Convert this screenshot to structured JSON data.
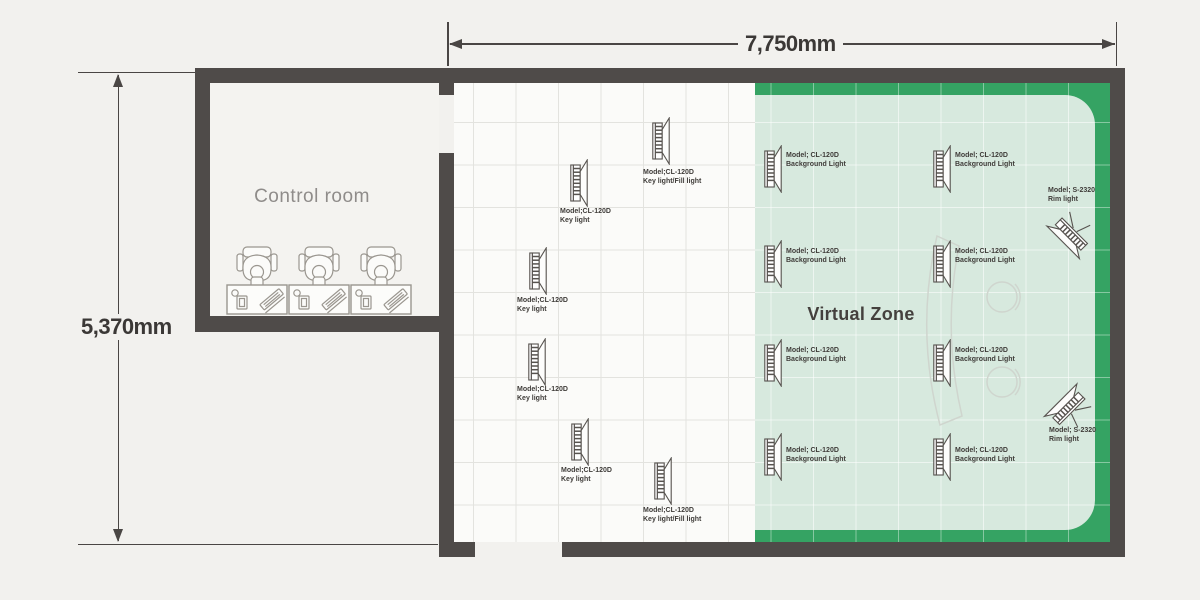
{
  "plan_title": "Studio lighting floor plan",
  "dimensions": {
    "width_label": "7,750mm",
    "height_label": "5,370mm"
  },
  "rooms": {
    "control_room_label": "Control room",
    "virtual_zone_label": "Virtual Zone",
    "workstation_count": 3
  },
  "colors": {
    "background": "#f2f1ee",
    "wall": "#4f4b49",
    "studio_floor": "#fbfbf9",
    "virtual_zone_accent": "#35a363",
    "virtual_zone_fill": "#d7e9de",
    "text_dark": "#3b3836",
    "text_gray": "#8f8c8a",
    "furniture_faint": "#cfd5ce"
  },
  "lights": [
    {
      "kind": "key",
      "model": "Model;CL-120D",
      "role": "Key light/Fill light",
      "x": 652,
      "y": 117,
      "label": {
        "x": 643,
        "y": 168
      }
    },
    {
      "kind": "key",
      "model": "Model;CL-120D",
      "role": "Key light",
      "x": 570,
      "y": 159,
      "label": {
        "x": 560,
        "y": 207
      }
    },
    {
      "kind": "key",
      "model": "Model;CL-120D",
      "role": "Key light",
      "x": 529,
      "y": 247,
      "label": {
        "x": 517,
        "y": 296
      }
    },
    {
      "kind": "key",
      "model": "Model;CL-120D",
      "role": "Key light",
      "x": 528,
      "y": 338,
      "label": {
        "x": 517,
        "y": 385
      }
    },
    {
      "kind": "key",
      "model": "Model;CL-120D",
      "role": "Key light",
      "x": 571,
      "y": 418,
      "label": {
        "x": 561,
        "y": 466
      }
    },
    {
      "kind": "key",
      "model": "Model;CL-120D",
      "role": "Key light/Fill light",
      "x": 654,
      "y": 457,
      "label": {
        "x": 643,
        "y": 506
      }
    },
    {
      "kind": "background",
      "model": "Model; CL-120D",
      "role": "Background Light",
      "x": 764,
      "y": 145,
      "label": {
        "x": 786,
        "y": 151
      }
    },
    {
      "kind": "background",
      "model": "Model; CL-120D",
      "role": "Background Light",
      "x": 764,
      "y": 240,
      "label": {
        "x": 786,
        "y": 247
      }
    },
    {
      "kind": "background",
      "model": "Model; CL-120D",
      "role": "Background Light",
      "x": 764,
      "y": 339,
      "label": {
        "x": 786,
        "y": 346
      }
    },
    {
      "kind": "background",
      "model": "Model; CL-120D",
      "role": "Background Light",
      "x": 764,
      "y": 433,
      "label": {
        "x": 786,
        "y": 446
      }
    },
    {
      "kind": "background",
      "model": "Model; CL-120D",
      "role": "Background Light",
      "x": 933,
      "y": 145,
      "label": {
        "x": 955,
        "y": 151
      }
    },
    {
      "kind": "background",
      "model": "Model; CL-120D",
      "role": "Background Light",
      "x": 933,
      "y": 240,
      "label": {
        "x": 955,
        "y": 247
      }
    },
    {
      "kind": "background",
      "model": "Model; CL-120D",
      "role": "Background Light",
      "x": 933,
      "y": 339,
      "label": {
        "x": 955,
        "y": 346
      }
    },
    {
      "kind": "background",
      "model": "Model; CL-120D",
      "role": "Background Light",
      "x": 933,
      "y": 433,
      "label": {
        "x": 955,
        "y": 446
      }
    },
    {
      "kind": "rim",
      "model": "Model; S-2320",
      "role": "Rim light",
      "x": 1056,
      "y": 203,
      "rotate": 135,
      "label": {
        "x": 1048,
        "y": 186
      }
    },
    {
      "kind": "rim",
      "model": "Model; S-2320",
      "role": "Rim light",
      "x": 1057,
      "y": 383,
      "rotate": -135,
      "label": {
        "x": 1049,
        "y": 426
      }
    }
  ]
}
